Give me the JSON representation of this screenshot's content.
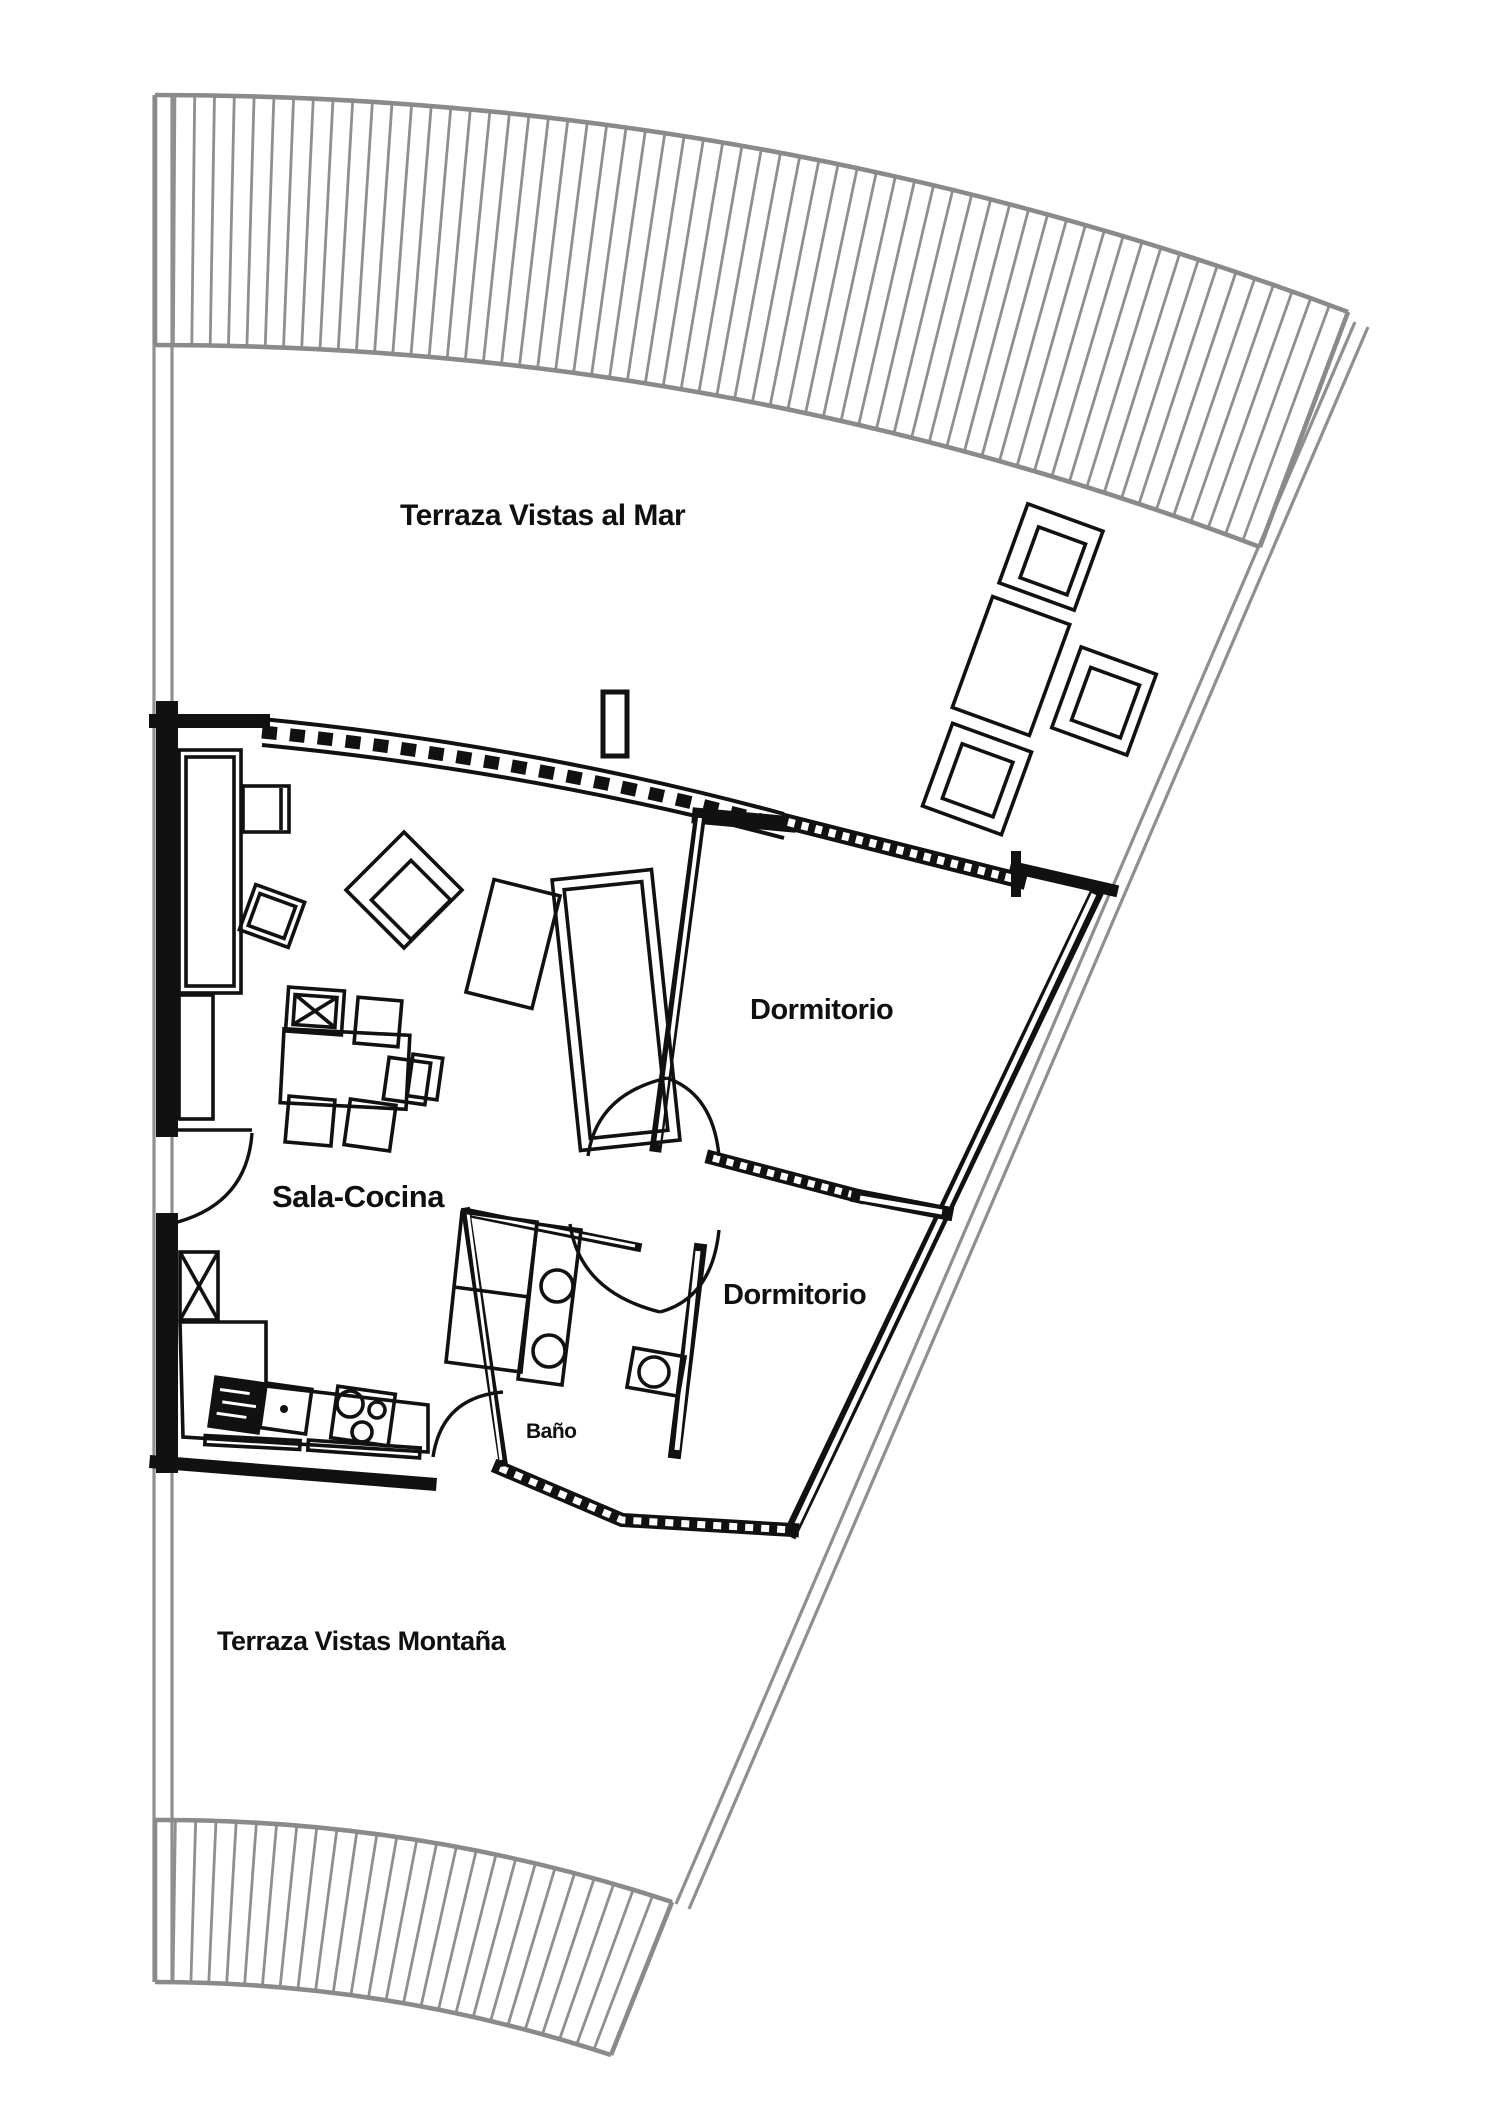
{
  "plan": {
    "type": "apartment floor plan",
    "labels": {
      "terrace_sea": "Terraza Vistas al Mar",
      "bedroom_top": "Dormitorio",
      "living_kitchen": "Sala-Cocina",
      "bedroom_mid": "Dormitorio",
      "bathroom": "Baño",
      "terrace_mountain": "Terraza Vistas Montaña"
    },
    "colors": {
      "walls": "#111111",
      "site_lines": "#8f8f8f",
      "background": "#ffffff",
      "text": "#101010"
    }
  }
}
